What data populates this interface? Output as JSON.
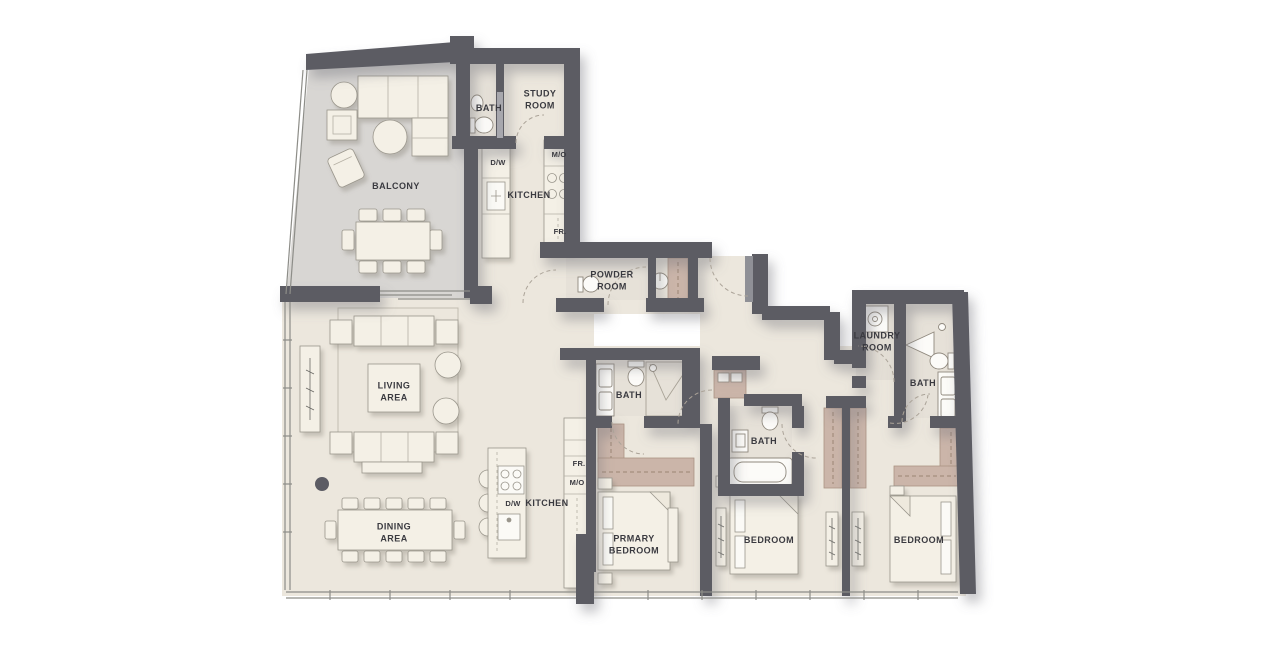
{
  "rooms": {
    "balcony": {
      "label": "BALCONY"
    },
    "bath_top": {
      "label": "BATH"
    },
    "study": {
      "label": "STUDY\nROOM"
    },
    "kitchen_top": {
      "label": "KITCHEN"
    },
    "powder": {
      "label": "POWDER\nROOM"
    },
    "living": {
      "label": "LIVING\nAREA"
    },
    "dining": {
      "label": "DINING\nAREA"
    },
    "kitchen_main": {
      "label": "KITCHEN"
    },
    "bath_primary": {
      "label": "BATH"
    },
    "bath_mid": {
      "label": "BATH"
    },
    "bath_right": {
      "label": "BATH"
    },
    "laundry": {
      "label": "LAUNDRY\nROOM"
    },
    "bedroom_primary": {
      "label": "PRMARY\nBEDROOM"
    },
    "bedroom_2": {
      "label": "BEDROOM"
    },
    "bedroom_3": {
      "label": "BEDROOM"
    }
  },
  "appliances": {
    "dw_top": "D/W",
    "mo_top": "M/O",
    "fr_top": "FR.",
    "dw_main": "D/W",
    "fr_main": "FR.",
    "mo_main": "M/O"
  },
  "colors": {
    "wall": "#5c5c64",
    "floor_main": "#ece7dd",
    "floor_balcony": "#d8d6d3",
    "floor_bath": "#e6e1d8",
    "wardrobe": "#cbb5a9",
    "furniture": "#f4f0e6"
  }
}
